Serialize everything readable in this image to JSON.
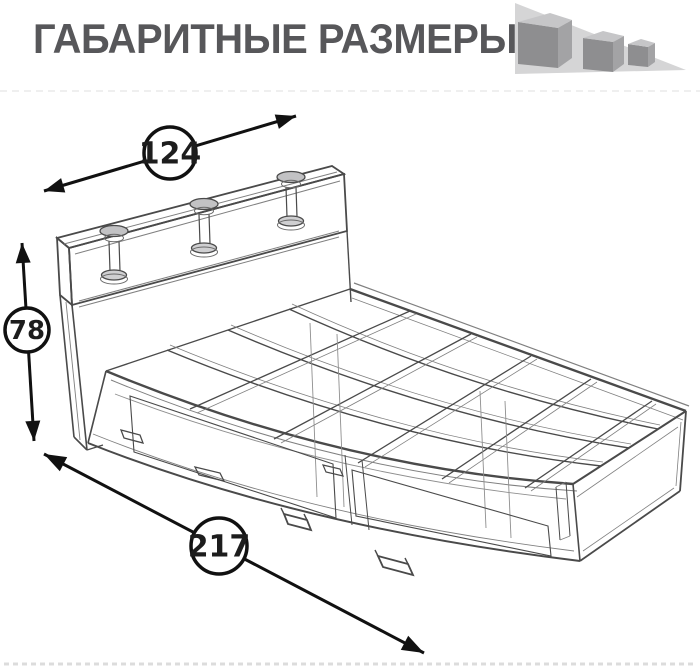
{
  "header": {
    "title": "ГАБАРИТНЫЕ РАЗМЕРЫ",
    "title_color": "#57575a"
  },
  "logo": {
    "name": "three-cubes-logo",
    "triangle_color": "#d5d5d6",
    "cube_top_color": "#c6c6c8",
    "cube_left_color": "#8e8e90",
    "cube_right_color": "#a3a3a5"
  },
  "drawing": {
    "type": "technical-wireframe",
    "subject": "bed-with-storage-drawers-overall-dimensions",
    "line_color": "#4a4a4a",
    "dimension_color": "#111111",
    "dimensions": [
      {
        "id": "width",
        "value": "124",
        "position": "top",
        "orientation": "diagonal-up-right"
      },
      {
        "id": "height",
        "value": "78",
        "position": "left",
        "orientation": "vertical"
      },
      {
        "id": "length",
        "value": "217",
        "position": "bottom",
        "orientation": "diagonal-down-right"
      }
    ]
  }
}
